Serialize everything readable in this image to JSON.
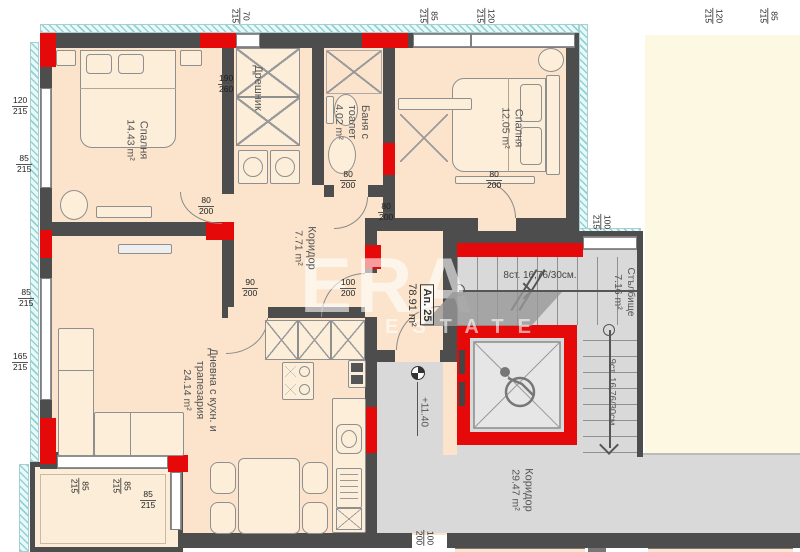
{
  "plan": {
    "apartment": {
      "number": "Ап. 25",
      "area": "78.91 m²"
    },
    "rooms": {
      "bedroom1": {
        "name": "Спалня",
        "area": "14.43 m²"
      },
      "closet": {
        "name": "Дрешник"
      },
      "bathroom": {
        "line1": "Баня с",
        "line2": "тоалет",
        "area": "4.02 m²"
      },
      "bedroom2": {
        "name": "Спалня",
        "area": "12.05 m²"
      },
      "hallway": {
        "name": "Коридор",
        "area": "7.71 m²"
      },
      "living": {
        "line1": "Дневна с кухн. и",
        "line2": "трапезария",
        "area": "24.14 m²"
      },
      "stairwell": {
        "name": "Стълбище",
        "area": "7.16 m²"
      },
      "corridor": {
        "name": "Коридор",
        "area": "29.47 m²"
      }
    },
    "annotations": {
      "elevation": "+11.40",
      "stairs_up": "8ст. 16,76/30см.",
      "stairs_down": "9ст. 16,76/30см"
    },
    "watermark": {
      "line1": "ERA",
      "line2": "ESTATE"
    },
    "colors": {
      "wall": "#4d4d4d",
      "accent_red": "#e60909",
      "floor_apartment": "#fbe4cb",
      "floor_common": "#d9d9d9",
      "adjacent_area": "#fdf8e1",
      "window_hatch": "#bfe8e8"
    },
    "dims": [
      {
        "n": "70",
        "d": "215"
      },
      {
        "n": "85",
        "d": "215"
      },
      {
        "n": "120",
        "d": "215"
      },
      {
        "n": "120",
        "d": "215"
      },
      {
        "n": "85",
        "d": "215"
      },
      {
        "n": "100",
        "d": "215"
      },
      {
        "n": "120",
        "d": "215"
      },
      {
        "n": "85",
        "d": "215"
      },
      {
        "n": "85",
        "d": "215"
      },
      {
        "n": "165",
        "d": "215"
      },
      {
        "n": "190",
        "d": "260"
      },
      {
        "n": "80",
        "d": "200"
      },
      {
        "n": "80",
        "d": "200"
      },
      {
        "n": "80",
        "d": "200"
      },
      {
        "n": "80",
        "d": "200"
      },
      {
        "n": "90",
        "d": "200"
      },
      {
        "n": "100",
        "d": "200"
      },
      {
        "n": "85",
        "d": "215"
      },
      {
        "n": "85",
        "d": "215"
      },
      {
        "n": "85",
        "d": "215"
      },
      {
        "n": "100",
        "d": "200"
      }
    ]
  }
}
